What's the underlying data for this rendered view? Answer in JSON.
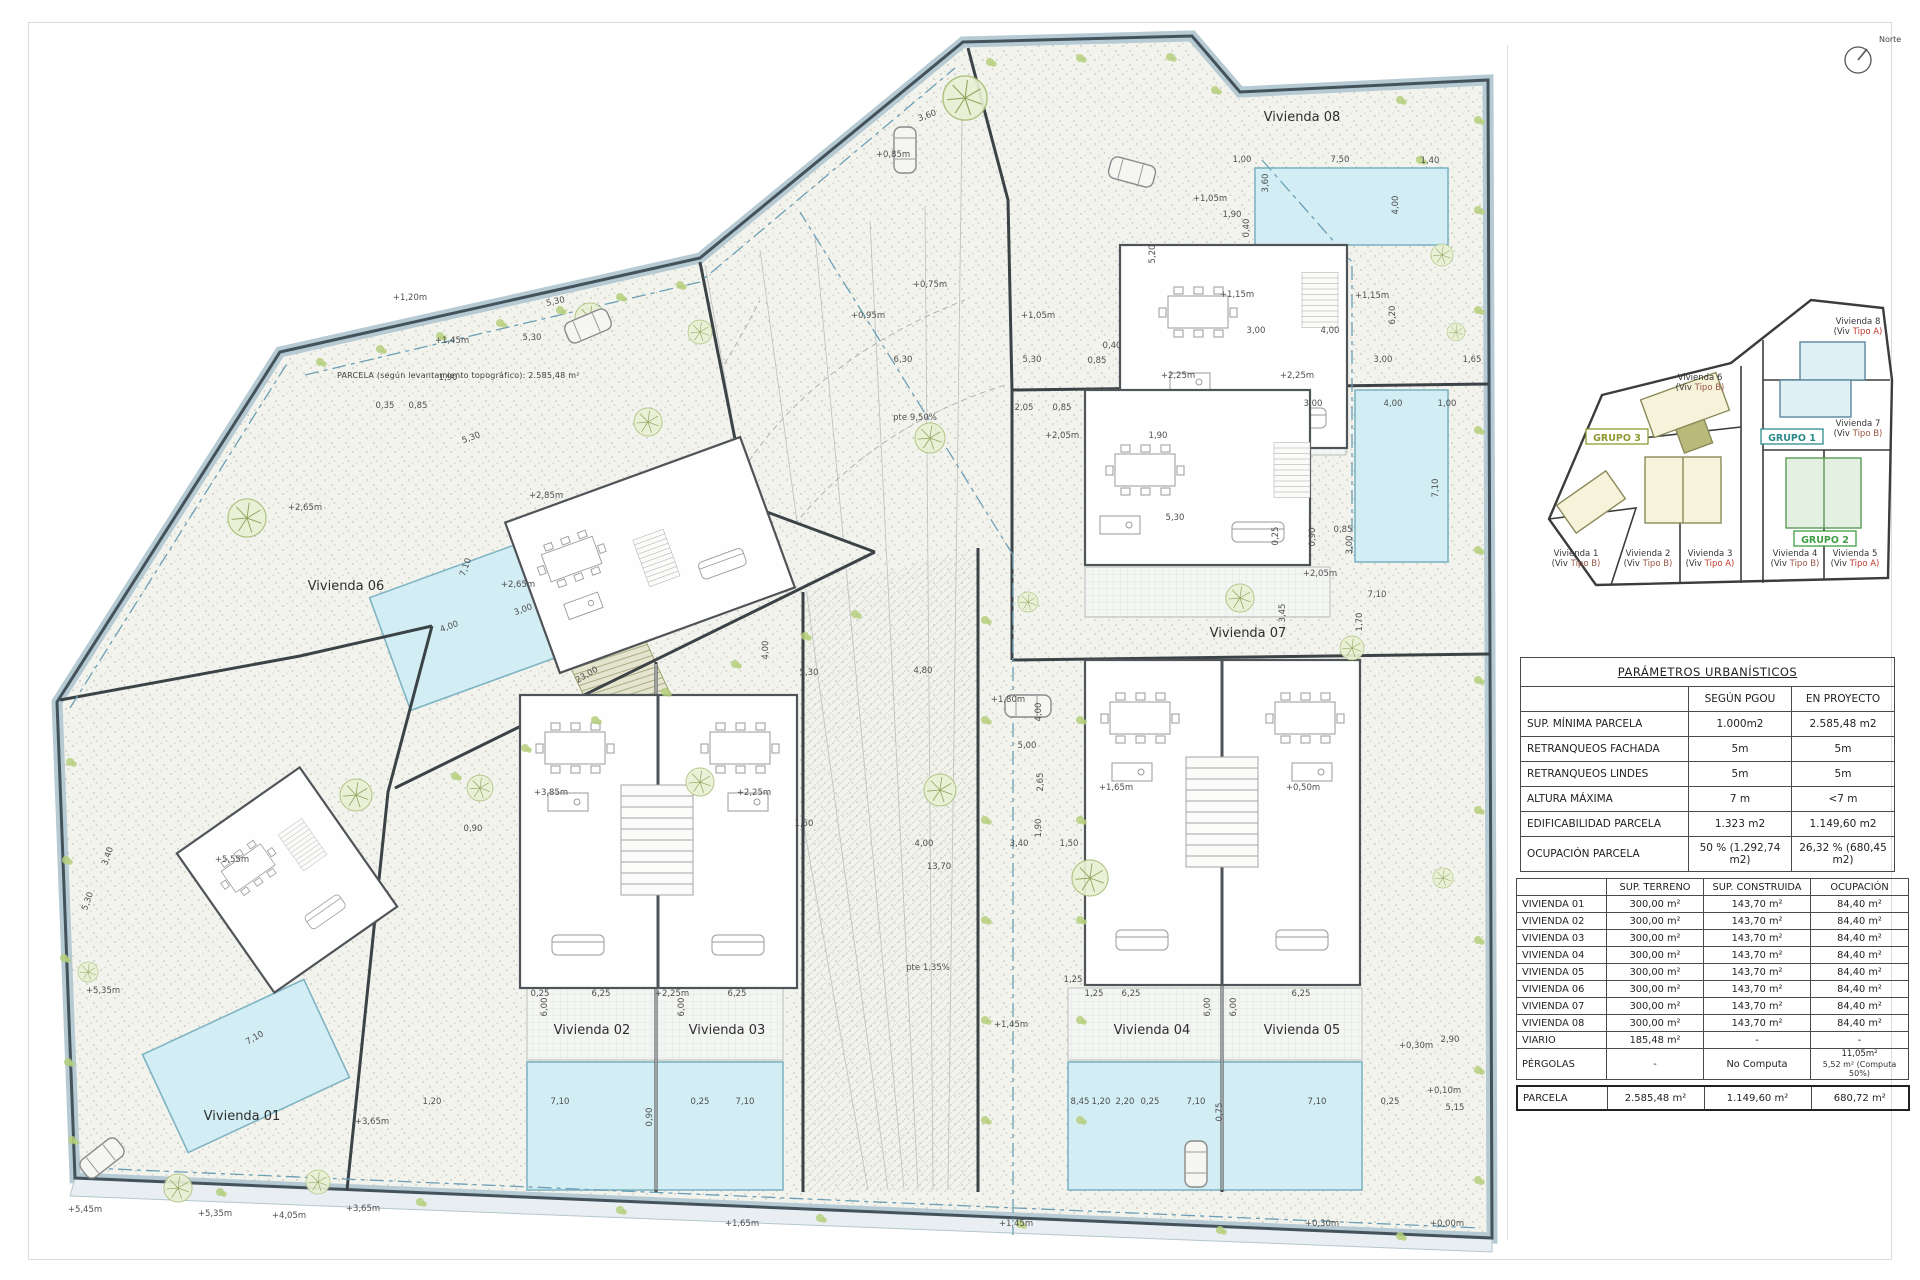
{
  "title_note": "PARCELA (según levantamiento topográfico): 2.585,48 m²",
  "north": {
    "label": "Norte"
  },
  "colors": {
    "boundary": "#44535b",
    "boundary_band": "#b6cad4",
    "pool": "#d2edf3",
    "pool_edge": "#7fb4c4",
    "plant": "#b5cf7c",
    "dash_blue": "#6b9fb5",
    "grupo1": "#2e8b8b",
    "grupo2": "#3f9d44",
    "grupo3": "#8f9a2f",
    "tipoA": "#c0392b",
    "tipoB": "#995544",
    "dim_text": "#4f4f4f"
  },
  "plan": {
    "unit_labels": [
      [
        "Vivienda 01",
        242,
        1120
      ],
      [
        "Vivienda 02",
        592,
        1034
      ],
      [
        "Vivienda 03",
        727,
        1034
      ],
      [
        "Vivienda 04",
        1152,
        1034
      ],
      [
        "Vivienda 05",
        1302,
        1034
      ],
      [
        "Vivienda 06",
        346,
        590
      ],
      [
        "Vivienda 07",
        1248,
        637
      ],
      [
        "Vivienda 08",
        1302,
        121
      ]
    ],
    "dim_labels": [
      [
        "+0,85m",
        893,
        157
      ],
      [
        "3,60",
        928,
        118,
        -20
      ],
      [
        "+1,05m",
        1210,
        201
      ],
      [
        "1,90",
        1232,
        217
      ],
      [
        "0,40",
        1249,
        228,
        -90
      ],
      [
        "1,00",
        1242,
        162
      ],
      [
        "7,50",
        1340,
        162
      ],
      [
        "1,40",
        1430,
        163
      ],
      [
        "3,60",
        1268,
        183,
        -90
      ],
      [
        "4,00",
        1398,
        205,
        -90
      ],
      [
        "+1,15m",
        1237,
        297
      ],
      [
        "+1,15m",
        1372,
        298
      ],
      [
        "5,20",
        1155,
        254,
        -90
      ],
      [
        "6,20",
        1395,
        315,
        -90
      ],
      [
        "3,00",
        1383,
        362
      ],
      [
        "1,65",
        1472,
        362
      ],
      [
        "3,00",
        1313,
        406
      ],
      [
        "4,00",
        1393,
        406
      ],
      [
        "1,00",
        1447,
        406
      ],
      [
        "+2,25m",
        1178,
        378
      ],
      [
        "+2,25m",
        1297,
        378
      ],
      [
        "+0,75m",
        930,
        287
      ],
      [
        "+0,95m",
        868,
        318
      ],
      [
        "+1,05m",
        1038,
        318
      ],
      [
        "5,30",
        1032,
        362
      ],
      [
        "0,85",
        1097,
        363
      ],
      [
        "0,40",
        1112,
        348
      ],
      [
        "6,30",
        903,
        362
      ],
      [
        "pte 9,50%",
        915,
        420
      ],
      [
        "+1,20m",
        410,
        300
      ],
      [
        "+1,45m",
        452,
        343
      ],
      [
        "5,30",
        532,
        340
      ],
      [
        "1,90",
        448,
        380
      ],
      [
        "5,30",
        556,
        304,
        -12
      ],
      [
        "0,35",
        385,
        408
      ],
      [
        "0,85",
        418,
        408
      ],
      [
        "2,05",
        1024,
        410
      ],
      [
        "0,85",
        1062,
        410
      ],
      [
        "+2,05m",
        1062,
        438
      ],
      [
        "1,90",
        1158,
        438
      ],
      [
        "3,00",
        1256,
        333
      ],
      [
        "4,00",
        1330,
        333
      ],
      [
        "+2,05m",
        1320,
        576
      ],
      [
        "3,00",
        1352,
        545,
        -90
      ],
      [
        "7,10",
        1377,
        597
      ],
      [
        "1,70",
        1362,
        622,
        -90
      ],
      [
        "3,45",
        1285,
        613,
        -90
      ],
      [
        "5,30",
        1175,
        520
      ],
      [
        "7,10",
        1438,
        488,
        -90
      ],
      [
        "0,90",
        1315,
        537,
        -90
      ],
      [
        "0,85",
        1343,
        532
      ],
      [
        "0,25",
        1278,
        536,
        -90
      ],
      [
        "+2,65m",
        305,
        510
      ],
      [
        "7,10",
        468,
        568,
        -70
      ],
      [
        "+2,85m",
        546,
        498
      ],
      [
        "5,30",
        472,
        440,
        -20
      ],
      [
        "+2,65m",
        518,
        587
      ],
      [
        "3,00",
        524,
        612,
        -20
      ],
      [
        "4,00",
        450,
        629,
        -20
      ],
      [
        "23,00",
        588,
        677,
        -30
      ],
      [
        "+3,85m",
        551,
        795
      ],
      [
        "+2,25m",
        754,
        795
      ],
      [
        "5,30",
        809,
        675
      ],
      [
        "4,00",
        768,
        650,
        -90
      ],
      [
        "1,50",
        804,
        826
      ],
      [
        "0,90",
        473,
        831
      ],
      [
        "6,25",
        601,
        996
      ],
      [
        "6,25",
        737,
        996
      ],
      [
        "0,25",
        540,
        996
      ],
      [
        "+2,25m",
        672,
        996
      ],
      [
        "6,00",
        547,
        1007,
        -90
      ],
      [
        "6,00",
        684,
        1007,
        -90
      ],
      [
        "1,20",
        432,
        1104
      ],
      [
        "7,10",
        560,
        1104
      ],
      [
        "0,25",
        700,
        1104
      ],
      [
        "7,10",
        745,
        1104
      ],
      [
        "0,90",
        652,
        1117,
        -90
      ],
      [
        "+5,55m",
        232,
        862
      ],
      [
        "+5,35m",
        103,
        993
      ],
      [
        "+5,35m",
        215,
        1216
      ],
      [
        "+5,45m",
        85,
        1212
      ],
      [
        "+4,05m",
        289,
        1218
      ],
      [
        "+3,65m",
        363,
        1211
      ],
      [
        "+3,65m",
        372,
        1124
      ],
      [
        "7,10",
        256,
        1040,
        -30
      ],
      [
        "3,40",
        110,
        857,
        -70
      ],
      [
        "5,30",
        90,
        902,
        -70
      ],
      [
        "4,80",
        923,
        673
      ],
      [
        "+1,80m",
        1008,
        702
      ],
      [
        "4,00",
        1041,
        712,
        -90
      ],
      [
        "5,00",
        1027,
        748
      ],
      [
        "2,65",
        1043,
        782,
        -90
      ],
      [
        "1,90",
        1041,
        828,
        -90
      ],
      [
        "3,40",
        1019,
        846
      ],
      [
        "1,50",
        1069,
        846
      ],
      [
        "4,00",
        924,
        846
      ],
      [
        "13,70",
        939,
        869
      ],
      [
        "pte 1,35%",
        928,
        970
      ],
      [
        "1,25",
        1073,
        982
      ],
      [
        "+1,45m",
        1011,
        1027
      ],
      [
        "+1,65m",
        1116,
        790
      ],
      [
        "+0,50m",
        1303,
        790
      ],
      [
        "1,25",
        1094,
        996
      ],
      [
        "6,25",
        1131,
        996
      ],
      [
        "6,25",
        1301,
        996
      ],
      [
        "6,00",
        1210,
        1007,
        -90
      ],
      [
        "6,00",
        1236,
        1007,
        -90
      ],
      [
        "8,45",
        1080,
        1104
      ],
      [
        "1,20",
        1101,
        1104
      ],
      [
        "2,20",
        1125,
        1104
      ],
      [
        "0,25",
        1150,
        1104
      ],
      [
        "7,10",
        1196,
        1104
      ],
      [
        "7,10",
        1317,
        1104
      ],
      [
        "0,25",
        1390,
        1104
      ],
      [
        "0,75",
        1222,
        1112,
        -90
      ],
      [
        "2,90",
        1450,
        1042
      ],
      [
        "+0,30m",
        1416,
        1048
      ],
      [
        "+0,10m",
        1444,
        1093
      ],
      [
        "5,15",
        1455,
        1110
      ],
      [
        "+0,00m",
        1447,
        1226
      ],
      [
        "+0,30m",
        1322,
        1226
      ],
      [
        "+1,45m",
        1016,
        1226
      ],
      [
        "+1,65m",
        742,
        1226
      ]
    ],
    "trees": [
      [
        965,
        98,
        22
      ],
      [
        700,
        332,
        12
      ],
      [
        590,
        318,
        15
      ],
      [
        648,
        422,
        14
      ],
      [
        247,
        518,
        19
      ],
      [
        930,
        438,
        15
      ],
      [
        356,
        795,
        16
      ],
      [
        480,
        788,
        13
      ],
      [
        700,
        782,
        14
      ],
      [
        940,
        790,
        16
      ],
      [
        1090,
        878,
        18
      ],
      [
        178,
        1188,
        14
      ],
      [
        318,
        1182,
        12
      ],
      [
        88,
        972,
        10
      ],
      [
        1352,
        648,
        12
      ],
      [
        1443,
        878,
        10
      ],
      [
        1028,
        602,
        10
      ],
      [
        1442,
        255,
        11
      ],
      [
        1456,
        332,
        9
      ],
      [
        1240,
        598,
        14
      ]
    ],
    "bushes": [
      [
        320,
        362
      ],
      [
        380,
        349
      ],
      [
        440,
        336
      ],
      [
        500,
        323
      ],
      [
        560,
        310
      ],
      [
        620,
        297
      ],
      [
        680,
        285
      ],
      [
        990,
        62
      ],
      [
        1080,
        58
      ],
      [
        1170,
        57
      ],
      [
        1215,
        90
      ],
      [
        1478,
        120
      ],
      [
        1478,
        210
      ],
      [
        1478,
        310
      ],
      [
        1478,
        430
      ],
      [
        1478,
        550
      ],
      [
        1478,
        680
      ],
      [
        1478,
        810
      ],
      [
        1478,
        940
      ],
      [
        1478,
        1070
      ],
      [
        1478,
        1180
      ],
      [
        220,
        1192
      ],
      [
        420,
        1202
      ],
      [
        620,
        1210
      ],
      [
        820,
        1218
      ],
      [
        1020,
        1224
      ],
      [
        1220,
        1230
      ],
      [
        1400,
        1236
      ],
      [
        70,
        762
      ],
      [
        66,
        860
      ],
      [
        64,
        958
      ],
      [
        68,
        1062
      ],
      [
        72,
        1140
      ],
      [
        455,
        776
      ],
      [
        525,
        748
      ],
      [
        595,
        720
      ],
      [
        665,
        692
      ],
      [
        735,
        664
      ],
      [
        805,
        636
      ],
      [
        855,
        614
      ],
      [
        985,
        620
      ],
      [
        985,
        720
      ],
      [
        985,
        820
      ],
      [
        985,
        920
      ],
      [
        985,
        1020
      ],
      [
        985,
        1120
      ],
      [
        1080,
        720
      ],
      [
        1080,
        820
      ],
      [
        1080,
        920
      ],
      [
        1080,
        1020
      ],
      [
        1080,
        1120
      ],
      [
        1400,
        100
      ],
      [
        1420,
        160
      ]
    ],
    "cars": [
      [
        905,
        150,
        90
      ],
      [
        588,
        326,
        -23
      ],
      [
        1028,
        706,
        0
      ],
      [
        1132,
        172,
        15
      ],
      [
        1196,
        1164,
        90
      ],
      [
        102,
        1158,
        -38
      ]
    ]
  },
  "key_plan": {
    "units": [
      {
        "name": "Vivienda 8",
        "tp": "(Viv",
        "tw": "Tipo A)",
        "t": "A",
        "x": 330,
        "y": 44
      },
      {
        "name": "Vivienda 6",
        "tp": "(Viv",
        "tw": "Tipo B)",
        "t": "B",
        "x": 172,
        "y": 100
      },
      {
        "name": "Vivienda 7",
        "tp": "(Viv",
        "tw": "Tipo B)",
        "t": "B",
        "x": 330,
        "y": 146
      },
      {
        "name": "Vivienda 1",
        "tp": "(Viv",
        "tw": "Tipo B)",
        "t": "B",
        "x": 48,
        "y": 276
      },
      {
        "name": "Vivienda 2",
        "tp": "(Viv",
        "tw": "Tipo B)",
        "t": "B",
        "x": 120,
        "y": 276
      },
      {
        "name": "Vivienda 3",
        "tp": "(Viv",
        "tw": "Tipo A)",
        "t": "A",
        "x": 182,
        "y": 276
      },
      {
        "name": "Vivienda 4",
        "tp": "(Viv",
        "tw": "Tipo B)",
        "t": "B",
        "x": 267,
        "y": 276
      },
      {
        "name": "Vivienda 5",
        "tp": "(Viv",
        "tw": "Tipo A)",
        "t": "A",
        "x": 327,
        "y": 276
      }
    ],
    "groups": [
      {
        "label": "GRUPO 3",
        "x": 89,
        "y": 160,
        "c": "grupo3"
      },
      {
        "label": "GRUPO 1",
        "x": 264,
        "y": 160,
        "c": "grupo1"
      },
      {
        "label": "GRUPO 2",
        "x": 297,
        "y": 262,
        "c": "grupo2"
      }
    ]
  },
  "params_table": {
    "title": "PARÁMETROS URBANÍSTICOS",
    "headers": [
      "",
      "SEGÚN  PGOU",
      "EN PROYECTO"
    ],
    "rows": [
      [
        "SUP. MÍNIMA PARCELA",
        "1.000m2",
        "2.585,48 m2"
      ],
      [
        "RETRANQUEOS FACHADA",
        "5m",
        "5m"
      ],
      [
        "RETRANQUEOS LINDES",
        "5m",
        "5m"
      ],
      [
        "ALTURA MÁXIMA",
        "7 m",
        "<7 m"
      ],
      [
        "EDIFICABILIDAD PARCELA",
        "1.323 m2",
        "1.149,60 m2"
      ],
      [
        "OCUPACIÓN PARCELA",
        "50 % (1.292,74 m2)",
        "26,32 % (680,45 m2)"
      ]
    ]
  },
  "areas_table": {
    "headers": [
      "",
      "SUP.  TERRENO",
      "SUP.  CONSTRUIDA",
      "OCUPACIÓN"
    ],
    "rows": [
      [
        "VIVIENDA 01",
        "300,00 m²",
        "143,70 m²",
        "84,40 m²"
      ],
      [
        "VIVIENDA 02",
        "300,00 m²",
        "143,70 m²",
        "84,40 m²"
      ],
      [
        "VIVIENDA 03",
        "300,00 m²",
        "143,70 m²",
        "84,40 m²"
      ],
      [
        "VIVIENDA 04",
        "300,00 m²",
        "143,70 m²",
        "84,40 m²"
      ],
      [
        "VIVIENDA 05",
        "300,00 m²",
        "143,70 m²",
        "84,40 m²"
      ],
      [
        "VIVIENDA 06",
        "300,00 m²",
        "143,70 m²",
        "84,40 m²"
      ],
      [
        "VIVIENDA 07",
        "300,00 m²",
        "143,70 m²",
        "84,40 m²"
      ],
      [
        "VIVIENDA 08",
        "300,00 m²",
        "143,70 m²",
        "84,40 m²"
      ],
      [
        "VIARIO",
        "185,48 m²",
        "-",
        "-"
      ],
      [
        "PÉRGOLAS",
        "-",
        "No Computa",
        "11,05m²"
      ]
    ],
    "pergolas_note": "5,52 m² (Computa 50%)",
    "footer": [
      "PARCELA",
      "2.585,48 m²",
      "1.149,60 m²",
      "680,72 m²"
    ]
  }
}
